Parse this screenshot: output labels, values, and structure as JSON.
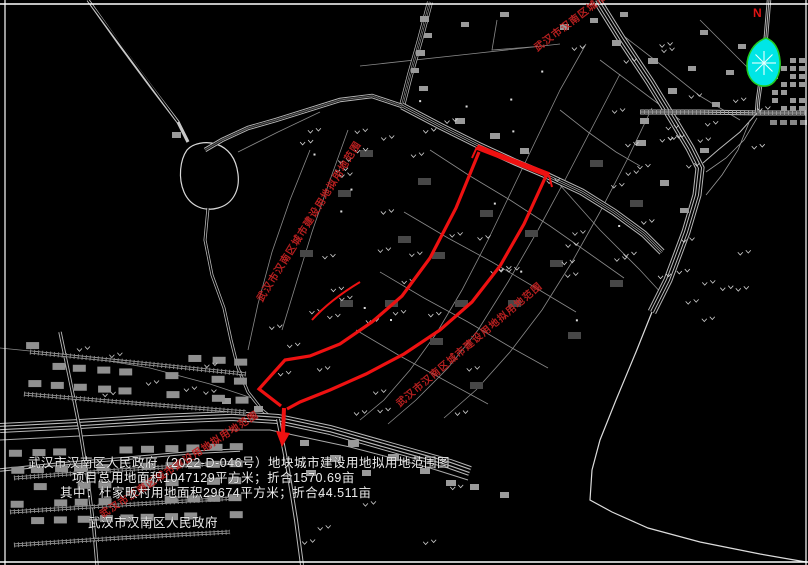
{
  "title_block": {
    "line1": "武汉市汉南区人民政府（2022-D-046号）地块城市建设用地拟用地范围图",
    "line2": "项目总用地面积1047129平方米；折合1570.69亩",
    "line3": "其中：杜家畈村用地面积29674平方米；折合44.511亩",
    "signature": "武汉市汉南区人民政府"
  },
  "map": {
    "route_label": "武汉市汉南区城市建设用地拟用地范围",
    "compass": "N"
  },
  "colors": {
    "background": "#000000",
    "linework": "#c8c8c8",
    "parcel": "#8a8a8a",
    "route_red": "#ee1111",
    "label_red": "#c42222",
    "vegetation_cyan": "#00e6e6",
    "vegetation_green": "#22cc22",
    "text_white": "#ededed"
  }
}
